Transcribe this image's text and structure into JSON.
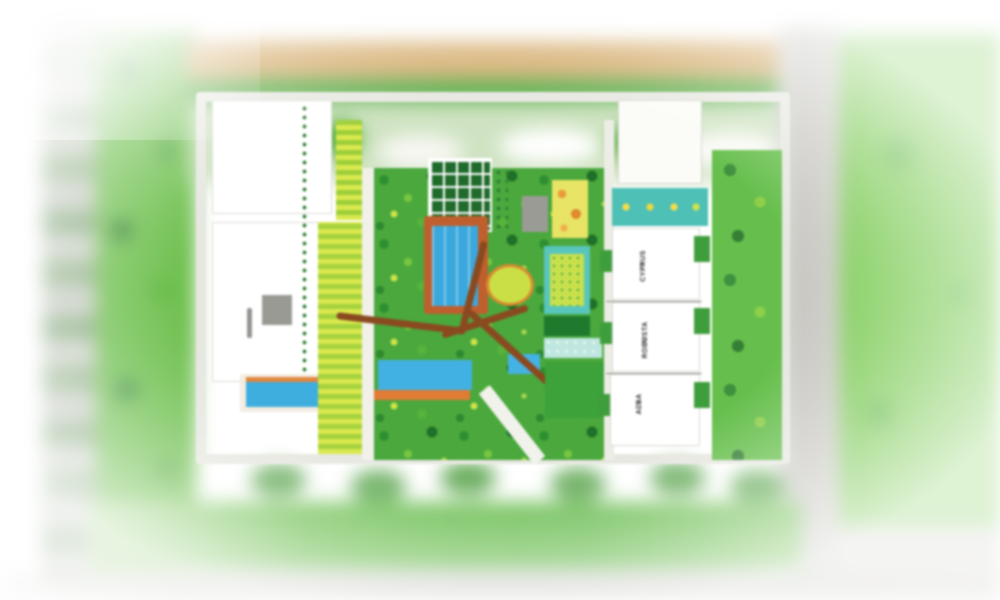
{
  "image": {
    "kind": "residential-masterplan-render",
    "description": "Blurred aerial master plan of a residential complex with central landscaped courtyard, swimming pools, sports court and apartment towers"
  },
  "towers": [
    {
      "name": "CYPRUS",
      "tier": "T4"
    },
    {
      "name": "ROBUSTA",
      "tier": "T5"
    },
    {
      "name": "ALBA",
      "tier": "T6"
    }
  ],
  "palette": {
    "lawn_green": "#7ccb55",
    "garden_green": "#4aa83d",
    "stripe_yellow": "#d9e84e",
    "pool_blue": "#41aede",
    "deck_terracotta": "#c2602c",
    "court_teal": "#54c4ba",
    "path_brown": "#8a4a20",
    "road_tan": "#d2a763",
    "road_gray": "#cac9c3"
  }
}
